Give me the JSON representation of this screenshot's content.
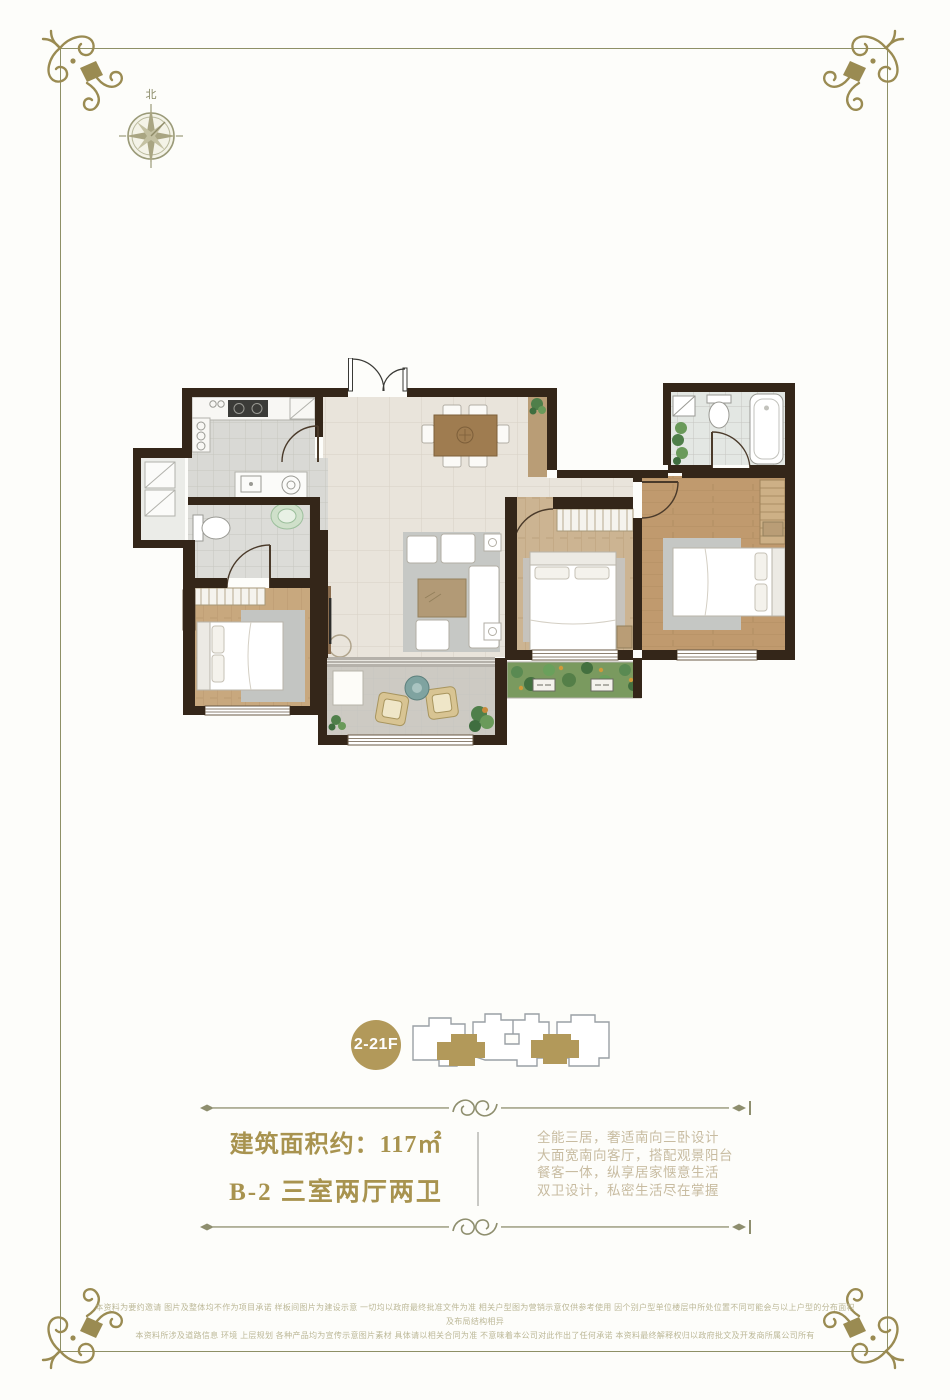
{
  "page": {
    "background": "#fdfdfa"
  },
  "frame": {
    "border_color": "#8e9066",
    "ornament_color": "#9a8b52"
  },
  "compass": {
    "north_label": "北"
  },
  "floor_plan": {
    "colors": {
      "wall": "#342619",
      "living_tile": "#e9e4db",
      "bedroom_wood": "#c8a87e",
      "bath_tile": "#dcdcd8",
      "accent_gold": "#b2995a"
    }
  },
  "floor_badge": {
    "label": "2-21F",
    "bg": "#b2995a",
    "text_color": "#ffffff"
  },
  "area_section": {
    "area_line": "建筑面积约：117㎡",
    "unit_line": "B-2 三室两厅两卫",
    "text_color": "#a8934f"
  },
  "description": {
    "lines": [
      "全能三居，奢适南向三卧设计",
      "大面宽南向客厅，搭配观景阳台",
      "餐客一体，纵享居家惬意生活",
      "双卫设计，私密生活尽在掌握"
    ]
  },
  "disclaimer": {
    "lines": [
      "本资料为要约邀请 图片及整体均不作为项目承诺 样板间图片为建设示意 一切均以政府最终批准文件为准 相关户型图为营销示意仅供参考使用 因个别户型单位楼层中所处位置不同可能会与以上户型的分布面积及布局结构相异",
      "本资料所涉及道路信息 环境 上层规划 各种产品均为宣传示意图片素材 具体请以相关合同为准 不意味着本公司对此作出了任何承诺 本资料最终解释权归以政府批文及开发商所属公司所有"
    ]
  }
}
